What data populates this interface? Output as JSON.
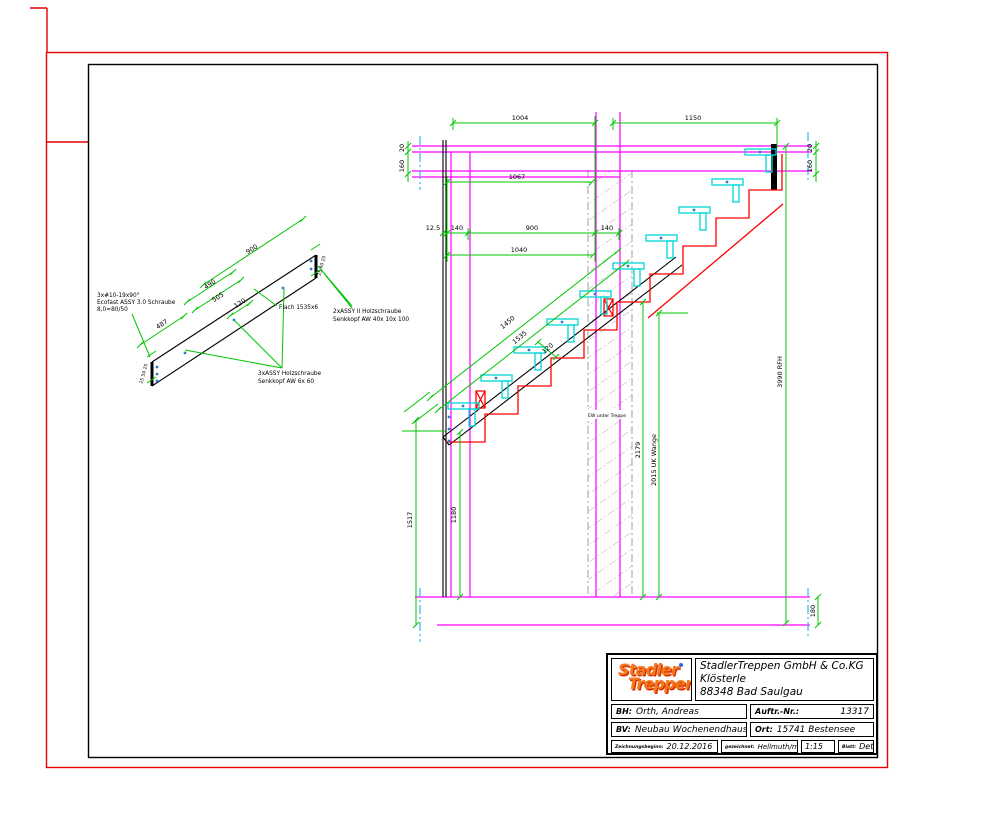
{
  "detail_drawing": {
    "labels": {
      "screws_left_1": "3x#10-19x90°",
      "screws_left_2": "Ecofast ASSY 3.0 Schraube",
      "screws_left_3": "8,0=80/50",
      "flat_bar": "Flach 1535x6",
      "screws_right_1": "2xASSY II Holzschraube",
      "screws_right_2": "Senkkopf AW 40x 10x 100",
      "screws_bottom_1": "3xASSY Holzschraube",
      "screws_bottom_2": "Senkkopf AW 6x 60"
    },
    "dims": {
      "length_900": "900",
      "length_490": "490",
      "length_505": "505",
      "length_120": "120",
      "length_487": "487",
      "end_left": "25 50 25",
      "end_right": "25 40 25"
    }
  },
  "section_drawing": {
    "dims": {
      "top_span_left": "1004",
      "top_span_right": "1150",
      "opening": "1067",
      "board": "12.5",
      "post_left": "140",
      "clear": "900",
      "wall": "140",
      "total": "1040",
      "slab_top_left": "20",
      "slab_left": "160",
      "slab_top_right": "20",
      "slab_right": "160",
      "height_1517": "1517",
      "height_1180": "1180",
      "height_2179": "2179",
      "uk_wange": "2015 UK Wange",
      "storey": "3990 RFH",
      "slab_bottom": "180",
      "stringer_1450": "1450",
      "stringer_1535": "1535",
      "offset_120": "120"
    },
    "labels": {
      "wall_under_stairs": "EW unter Treppe"
    }
  },
  "title_block": {
    "logo_line1": "Stadler",
    "logo_line2": "Treppen",
    "company_line1": "StadlerTreppen GmbH &  Co.KG",
    "company_line2": "Klösterle",
    "company_line3": "88348 Bad Saulgau",
    "bh_label": "BH:",
    "bh_value": "Orth, Andreas",
    "auftr_label": "Auftr.-Nr.:",
    "auftr_value": "13317",
    "bv_label": "BV:",
    "bv_value": "Neubau Wochenendhaus",
    "ort_label": "Ort:",
    "ort_value": "15741 Bestensee",
    "start_label": "Zeichnungsbeginn:",
    "start_value": "20.12.2016",
    "drawn_label": "gezeichnet:",
    "drawn_value": "Hellmuth/ml",
    "scale_value": "M 1:15",
    "sheet_label": "Blatt:",
    "sheet_value": "Detail"
  }
}
